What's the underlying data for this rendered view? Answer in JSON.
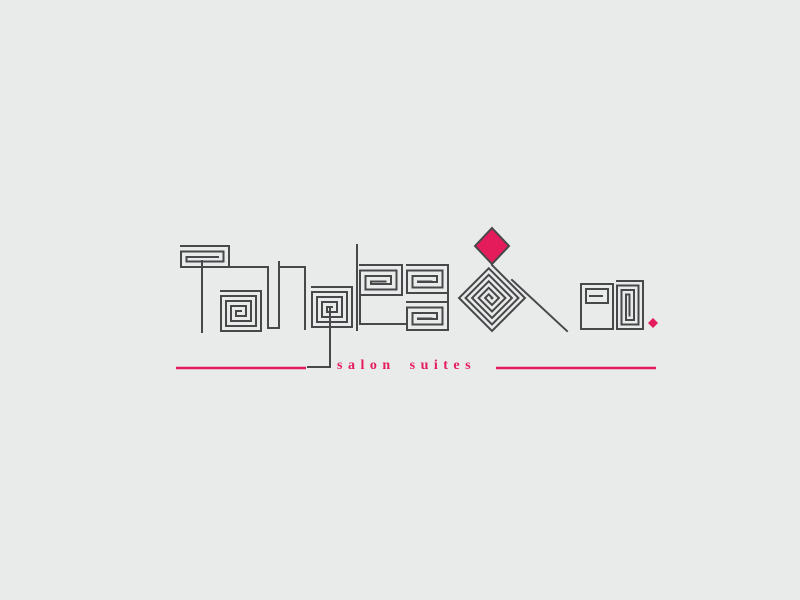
{
  "logo": {
    "brand": "Tangles & co.",
    "brand_letters": [
      "T",
      "a",
      "n",
      "g",
      "l",
      "e",
      "s",
      "&",
      "c",
      "o",
      "."
    ],
    "tagline": "salon suites"
  },
  "colors": {
    "background": "#e9eaea",
    "ink": "#48484a",
    "accent": "#e41c5c"
  }
}
